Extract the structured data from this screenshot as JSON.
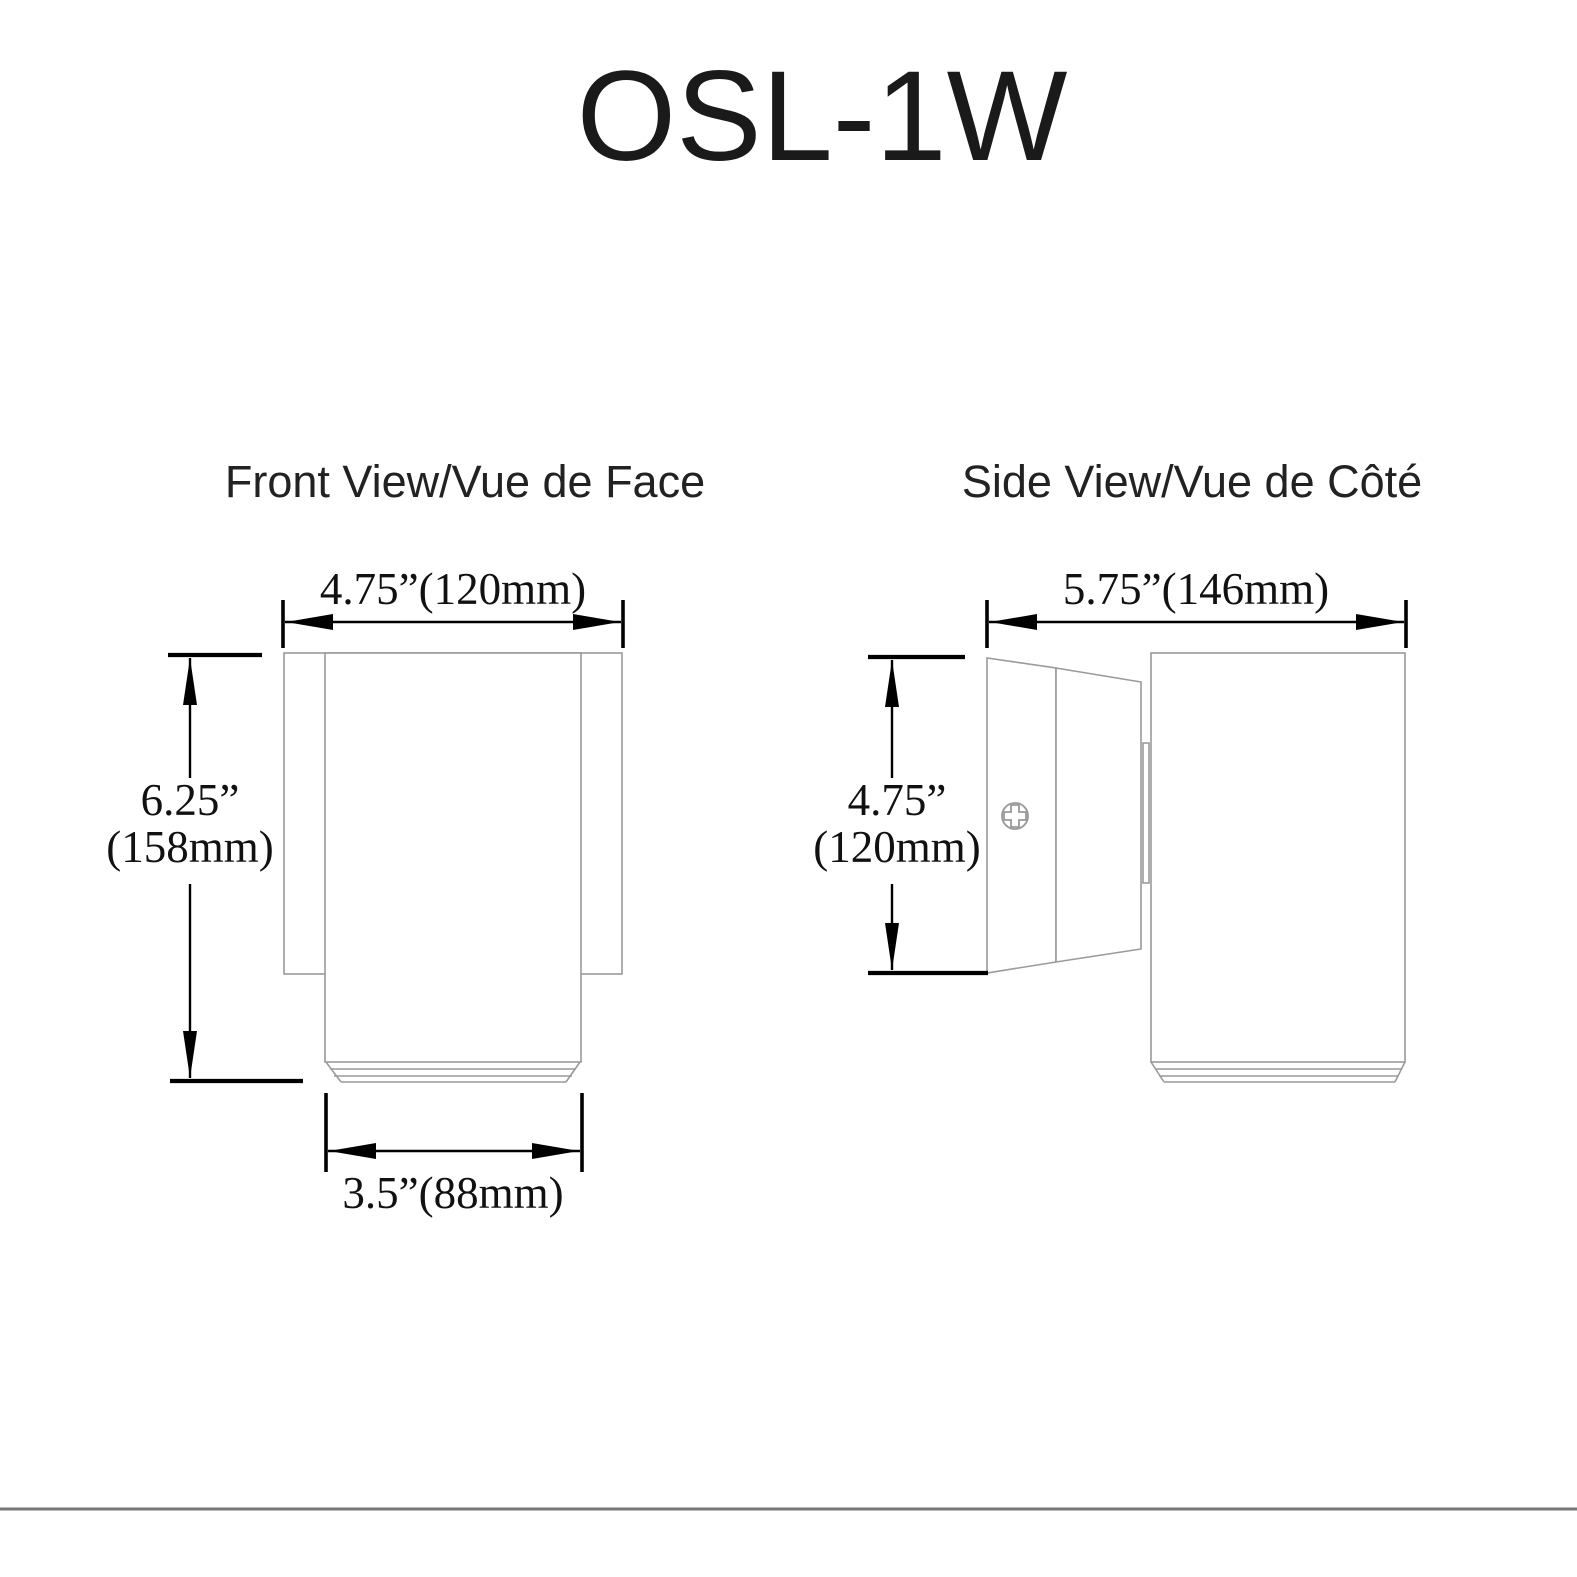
{
  "title": "OSL-1W",
  "front_view": {
    "label": "Front View/Vue de Face",
    "width_dim": "4.75”(120mm)",
    "height_dim_in": "6.25”",
    "height_dim_mm": "(158mm)",
    "lens_dim": "3.5”(88mm)"
  },
  "side_view": {
    "label": "Side View/Vue de Côté",
    "depth_dim": "5.75”(146mm)",
    "height_dim_in": "4.75”",
    "height_dim_mm": "(120mm)"
  },
  "colors": {
    "outline": "#9a9a9a",
    "dimension": "#000000",
    "text": "#1a1a1a",
    "divider": "#777777"
  }
}
